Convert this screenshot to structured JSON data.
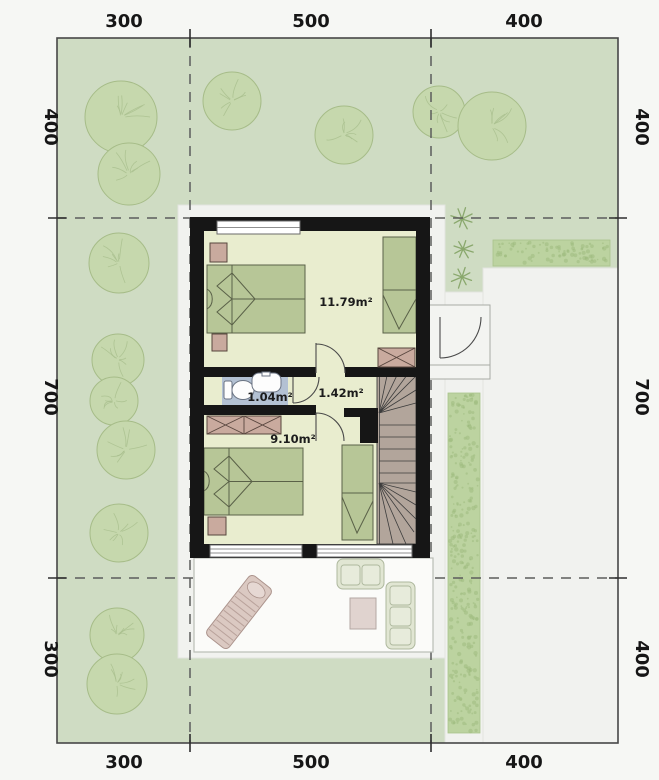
{
  "plan": {
    "dimensions_top": [
      "300",
      "500",
      "400"
    ],
    "dimensions_bottom": [
      "300",
      "500",
      "400"
    ],
    "dimensions_left": [
      "400",
      "700",
      "300"
    ],
    "dimensions_right": [
      "400",
      "700",
      "400"
    ],
    "areas": {
      "bedroom1": "11.79m²",
      "hall": "1.42m²",
      "bathroom": "1.04m²",
      "bedroom2": "9.10m²"
    },
    "colors": {
      "lawn": "#cfdcc3",
      "paving": "#f1f2ef",
      "wall": "#161616",
      "floor": "#e9edcf",
      "bath": "#b3c1d3",
      "bed": "#b7c697",
      "pink": "#c9aa9e",
      "stairs": "#b2a59b",
      "tree": "#c6d8ad",
      "hedge": "#bcd3a0",
      "ink": "#161616"
    }
  }
}
